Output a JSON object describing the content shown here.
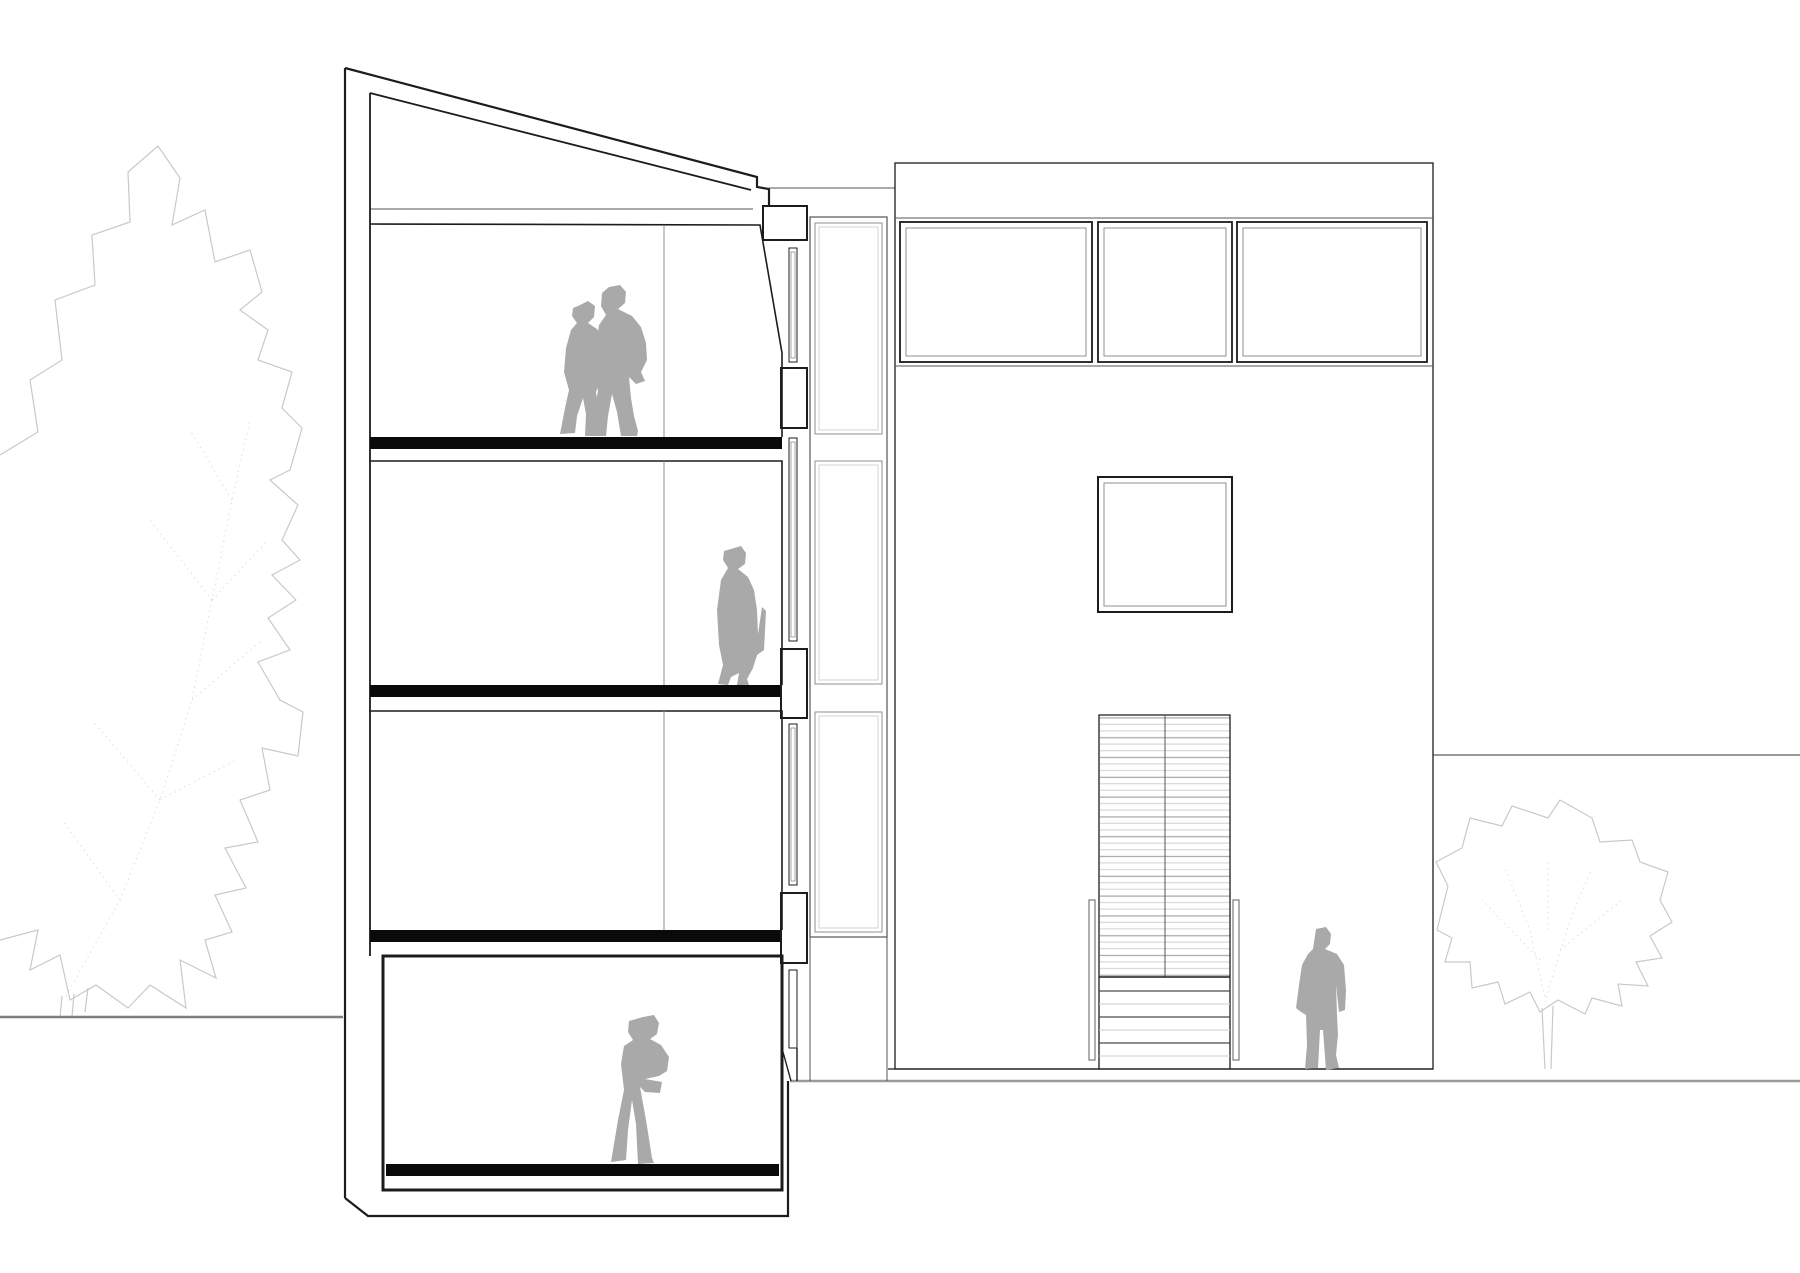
{
  "page": {
    "title": "Architectural drawing — building cross-section and entrance elevation",
    "background": "#ffffff"
  },
  "colors": {
    "bg": "#ffffff",
    "ink": "#1c1c1c",
    "slab": "#0a0a0a",
    "thin": "#555555",
    "inner_frame": "#8f8f8f",
    "divider": "#aaaaaa",
    "figure": "#a9a9a9",
    "tree": "#c9c9c9",
    "tree_dot": "#dedede",
    "terrain": "#7e7e7e",
    "terrain_light": "#9a9a9a",
    "slat_light": "#d4d4d4",
    "slat_dark": "#ababab",
    "step_light": "#cccccc",
    "step_dark": "#4a4a4a",
    "rail": "#7a7a7a"
  },
  "scene": {
    "kind": "line drawing, no text",
    "left_half": {
      "name": "building cross-section",
      "floors": 4,
      "roof": "mono-pitch roof sloping down to the right",
      "slabs": "solid black floor slabs",
      "right_edge": "stepped wall with narrow window slots and a 3-panel glazed stair strip",
      "figures": [
        "couple standing together on the top floor",
        "woman with backpack standing on the second floor",
        "man with crossed arms on the ground floor"
      ]
    },
    "right_half": {
      "name": "entrance elevation",
      "clerestory_windows": 3,
      "square_window": 1,
      "entrance": "tall slatted opening with exterior stair, two handrails",
      "figure": "man standing to the right of the entrance stair"
    },
    "environment": {
      "trees": 2,
      "terrain": [
        "upper grade line at left of section",
        "thin ground line under elevation",
        "heavy grade line running to right edge",
        "background wall line behind right tree"
      ]
    }
  }
}
